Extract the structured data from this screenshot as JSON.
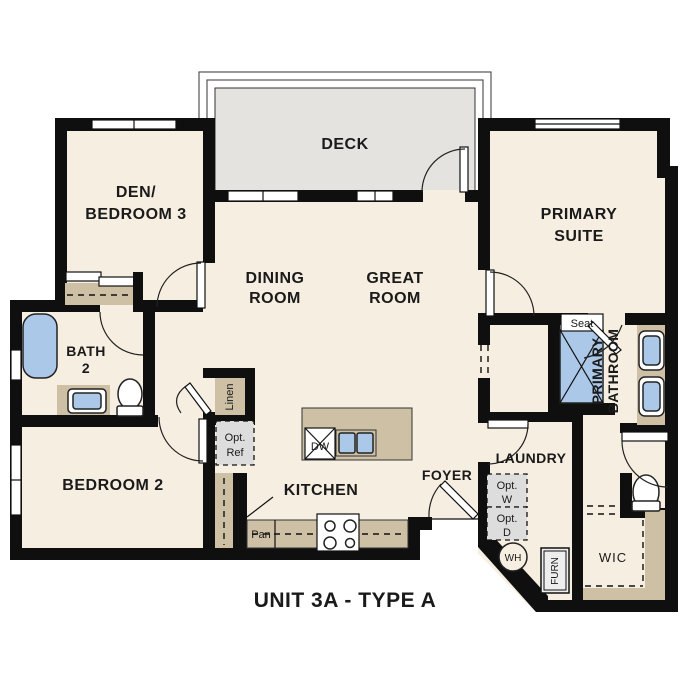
{
  "plan_title": "UNIT 3A - TYPE A",
  "rooms": {
    "deck": {
      "label": "DECK"
    },
    "den": {
      "line1": "DEN/",
      "line2": "BEDROOM 3"
    },
    "dining": {
      "line1": "DINING",
      "line2": "ROOM"
    },
    "great": {
      "line1": "GREAT",
      "line2": "ROOM"
    },
    "primary_suite": {
      "line1": "PRIMARY",
      "line2": "SUITE"
    },
    "bath2": {
      "line1": "BATH",
      "line2": "2"
    },
    "bedroom2": {
      "label": "BEDROOM 2"
    },
    "kitchen": {
      "label": "KITCHEN"
    },
    "foyer": {
      "label": "FOYER"
    },
    "laundry": {
      "label": "LAUNDRY"
    },
    "primary_bathroom": {
      "line1": "PRIMARY",
      "line2": "BATHROOM"
    },
    "wic": {
      "label": "WIC"
    }
  },
  "fixtures": {
    "seat": "Seat",
    "dishwasher": "DW",
    "pantry": "Pan",
    "linen": "Linen",
    "opt_ref": {
      "line1": "Opt.",
      "line2": "Ref"
    },
    "opt_washer": {
      "line1": "Opt.",
      "line2": "W"
    },
    "opt_dryer": {
      "line1": "Opt.",
      "line2": "D"
    },
    "water_heater": "WH",
    "furnace": "FURN"
  },
  "colors": {
    "wall": "#0f0f0f",
    "floor": "#f6eee1",
    "deck": "#e4e3e0",
    "counter": "#cec0a5",
    "plumbing_fixture": "#abc8e8",
    "optional_appliance": "#dddddd"
  }
}
